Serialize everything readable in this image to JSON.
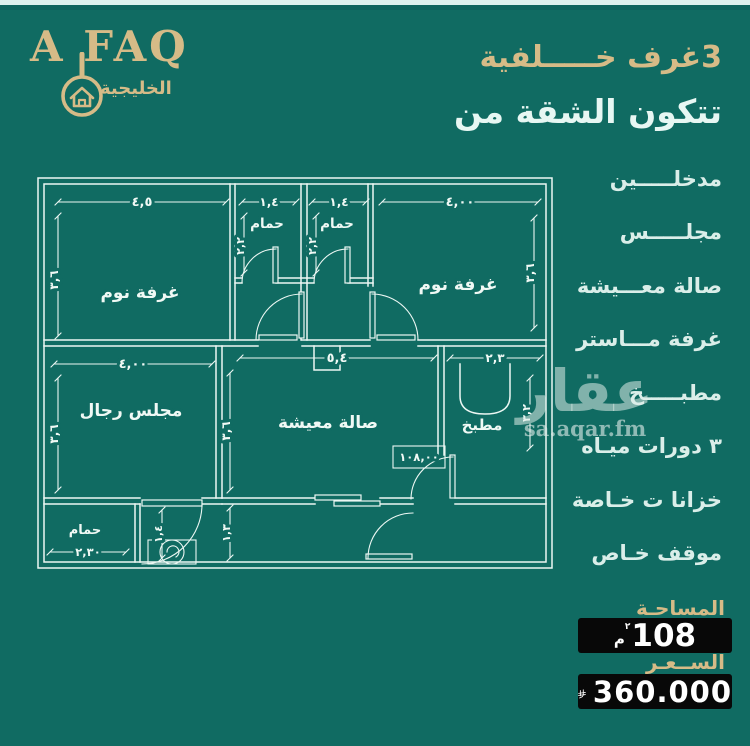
{
  "colors": {
    "background": "#106b62",
    "accent": "#d6bb87",
    "ink": "#ecf7f3",
    "box": "#080808"
  },
  "logo": {
    "brand": "A FAQ",
    "subtitle": "الخليجية",
    "icon": "key-house-icon"
  },
  "header": {
    "title": "3غرف خـــــلفية",
    "subtitle": "تتكون الشقة من"
  },
  "features": {
    "items": [
      {
        "label": "مدخلـــــين"
      },
      {
        "label": "مجلـــــس"
      },
      {
        "label": "صالة معـــيشة"
      },
      {
        "label": "غرفة مـــاستر"
      },
      {
        "label": "مطبـــــخ"
      },
      {
        "label": "٣ دورات ميـاه"
      },
      {
        "label": "خزانا ت خـاصة"
      },
      {
        "label": "موقف خـاص"
      }
    ]
  },
  "watermark": {
    "logo_text": "عقار",
    "site": "sa.aqar.fm"
  },
  "summary": {
    "area_label": "المساحـة",
    "area_value": "108",
    "area_unit_letter": "م",
    "area_unit_sup": "٢",
    "price_label": "الســعـر",
    "price_value": "360.000",
    "currency_icon": "saudi-riyal"
  },
  "plan": {
    "labels": {
      "bedroom1": "غرفة نوم",
      "bath1": "حمام",
      "bath2": "حمام",
      "bedroom2": "غرفة نوم",
      "majlis": "مجلس رجال",
      "living": "صالة معيشة",
      "kitchen": "مطبخ",
      "bath3": "حمام"
    },
    "dims": {
      "bedroom1_w": "٤,٥",
      "bedroom1_h": "٣,٦",
      "bath1_w": "١,٤",
      "bath1_h": "٢,٢",
      "bath2_w": "١,٤",
      "bath2_h": "٢,٢",
      "bedroom2_w": "٤,٠٠",
      "bedroom2_h": "٣,٦",
      "majlis_w": "٤,٠٠",
      "majlis_h": "٣,٦",
      "living_w": "٥,٤",
      "living_h": "٣,٦",
      "kitchen_w": "٢,٣",
      "kitchen_h": "٣,٢",
      "bath3_w": "٢,٣٠",
      "bath3_h": "١,٤",
      "entry_h": "١,٣",
      "area_box": "١٠٨,٠٠"
    }
  }
}
